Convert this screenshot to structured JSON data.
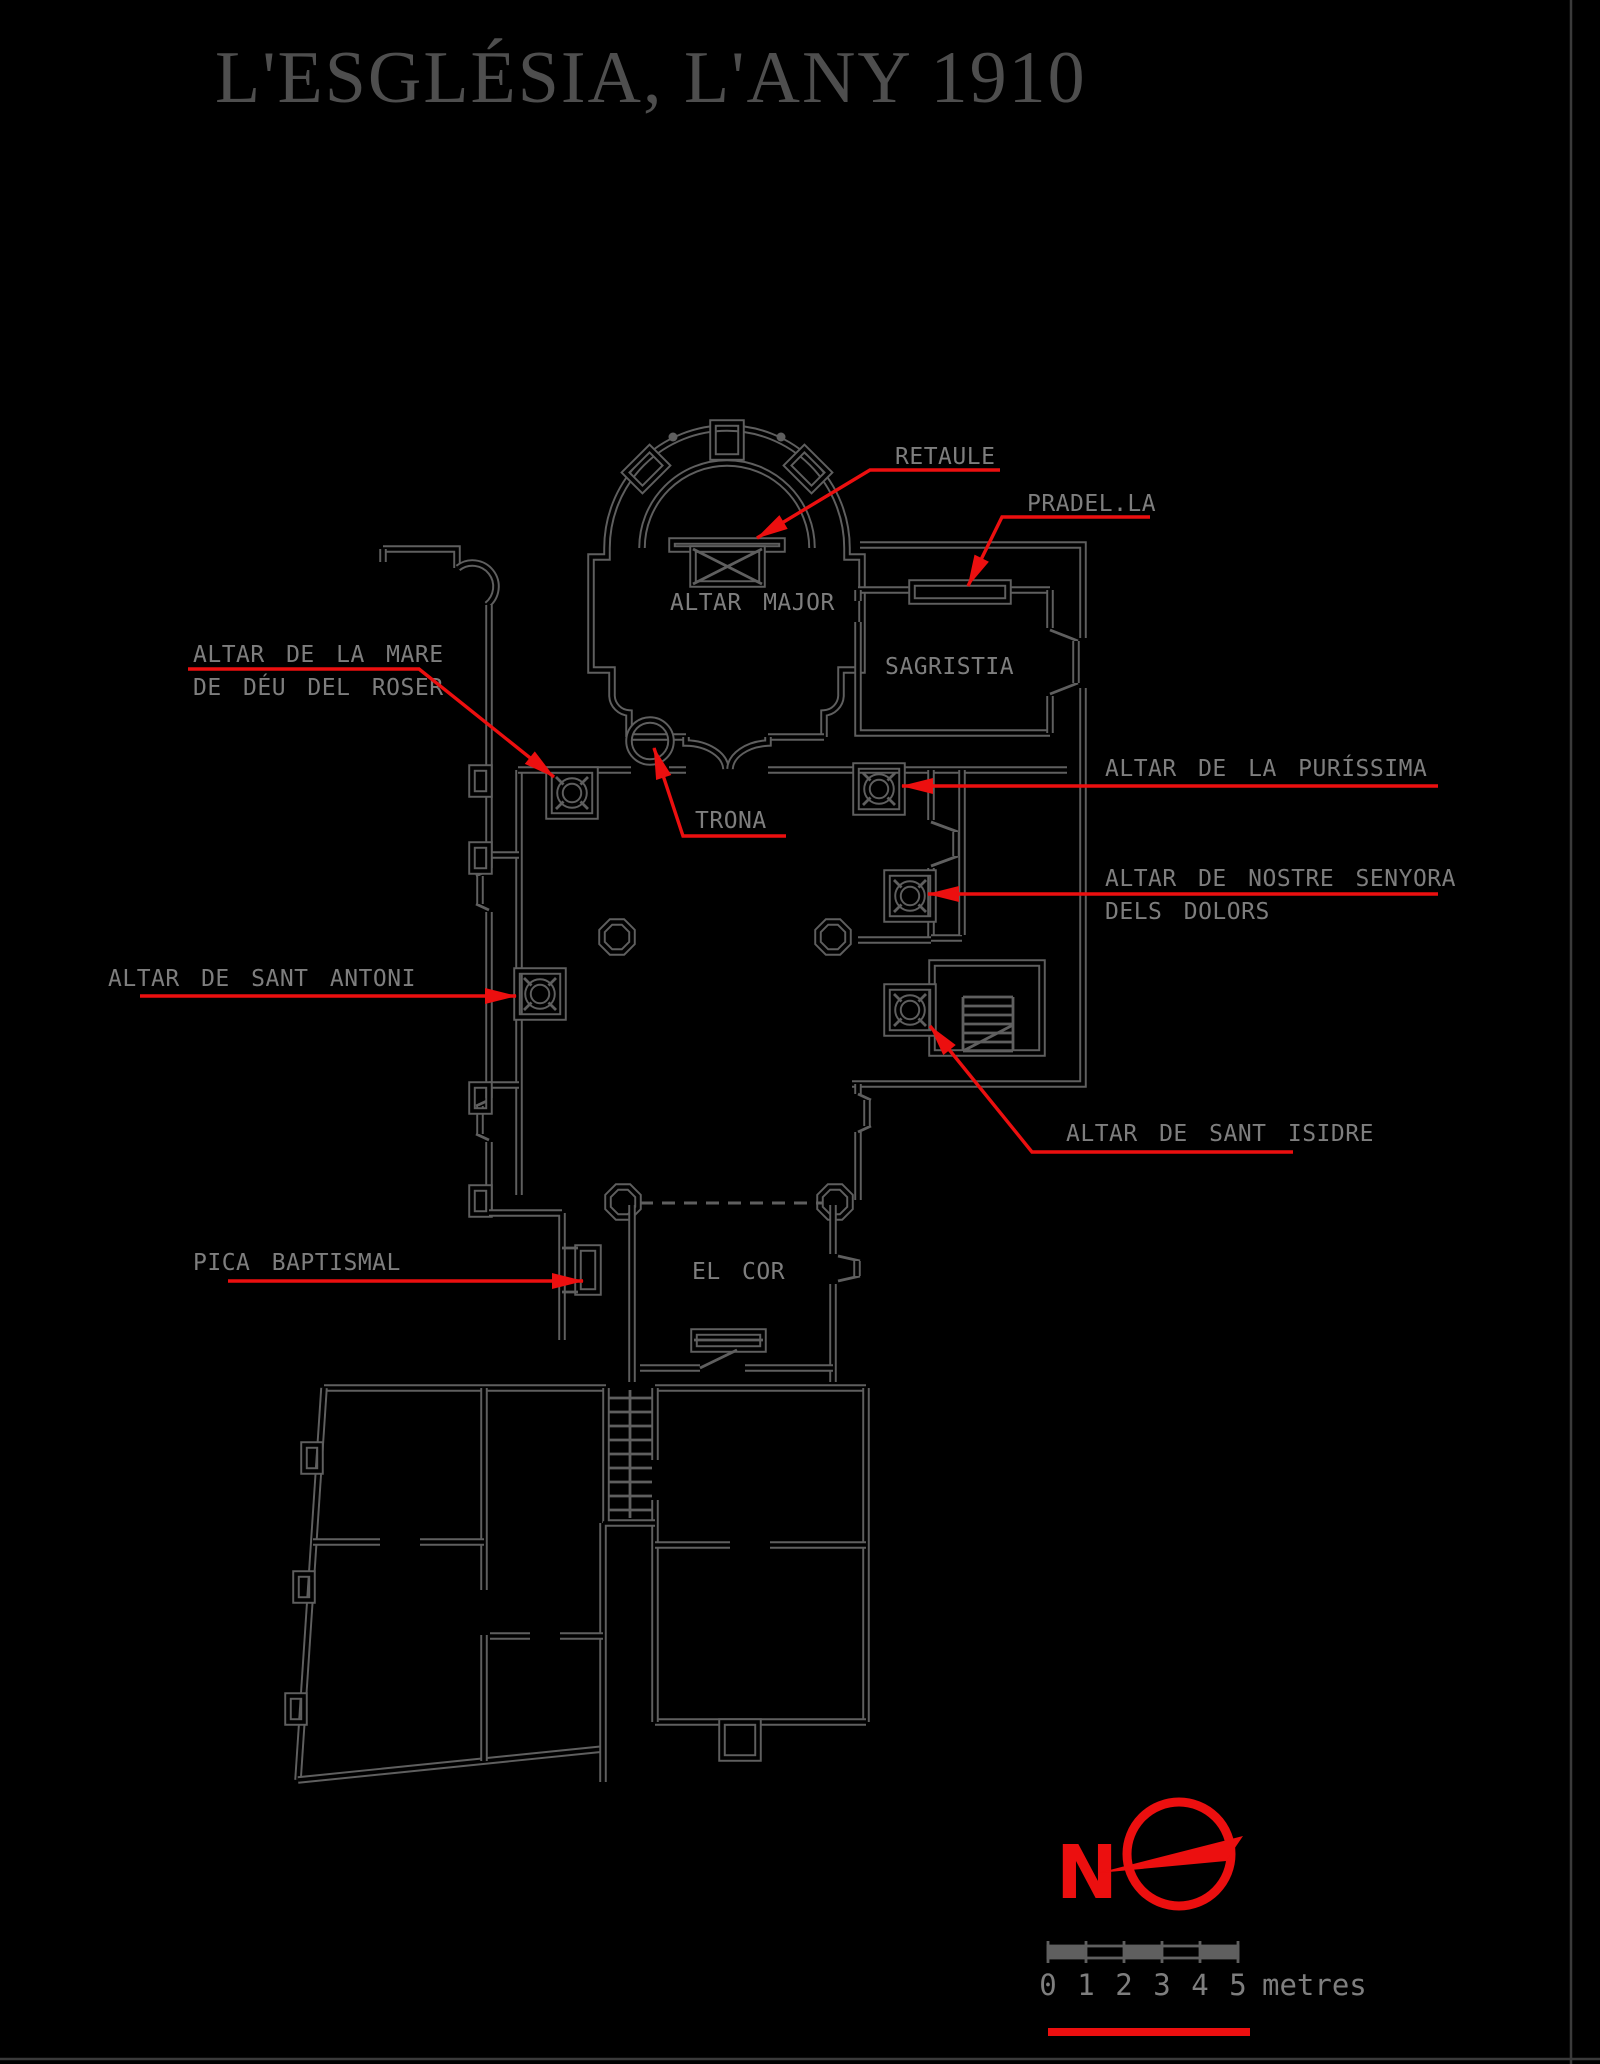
{
  "title": "L'ESGLÉSIA, L'ANY 1910",
  "colors": {
    "bg": "#000000",
    "wall": "#5f5f5f",
    "label_gray": "#7e7e7e",
    "title_gray": "#4e4e4e",
    "accent_red": "#ec0f0f"
  },
  "rooms": {
    "altar_major": "ALTAR MAJOR",
    "sagristia": "SAGRISTIA",
    "el_cor": "EL COR"
  },
  "labels": {
    "retaule": "RETAULE",
    "pradella": "PRADEL.LA",
    "roser_line1": "ALTAR DE LA MARE",
    "roser_line2": "DE DÉU DEL ROSER",
    "trona": "TRONA",
    "purissima": "ALTAR DE LA PURÍSSIMA",
    "dolors_line1": "ALTAR DE NOSTRE SENYORA",
    "dolors_line2": "DELS DOLORS",
    "antoni": "ALTAR DE SANT ANTONI",
    "isidre": "ALTAR DE SANT ISIDRE",
    "pica": "PICA BAPTISMAL"
  },
  "compass": {
    "north_letter": "N"
  },
  "scale_bar": {
    "ticks": [
      "0",
      "1",
      "2",
      "3",
      "4",
      "5"
    ],
    "unit": "metres"
  }
}
